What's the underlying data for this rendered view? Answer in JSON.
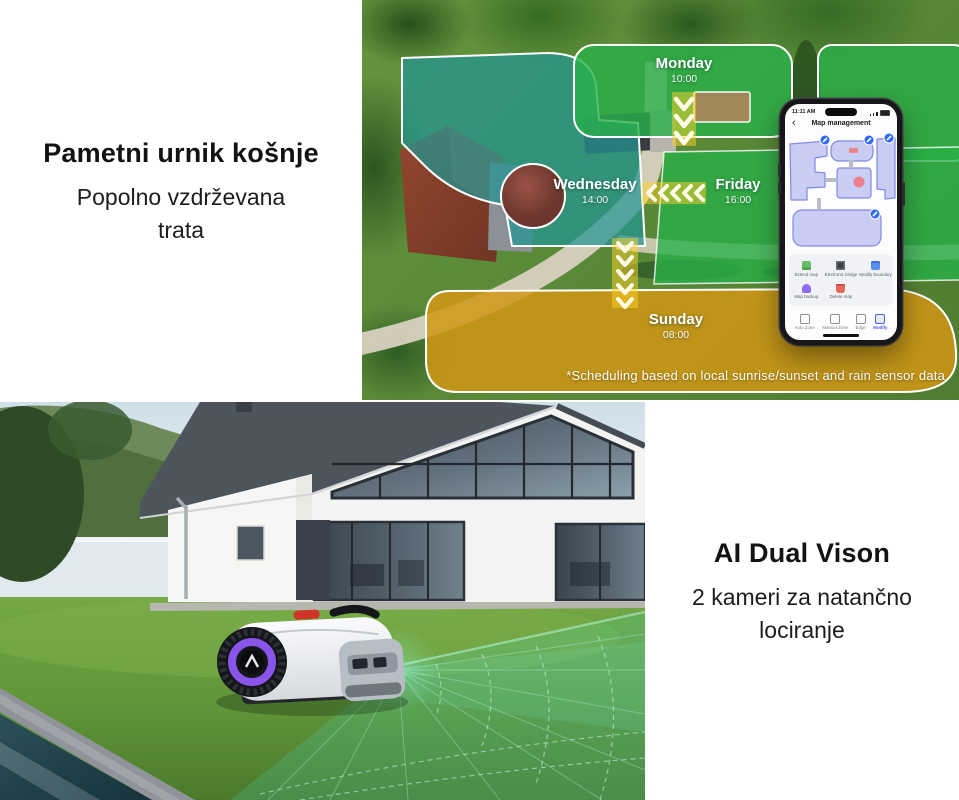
{
  "schedule_section": {
    "heading": "Pametni urnik košnje",
    "subheading": "Popolno vzdrževana trata",
    "disclaimer": "*Scheduling based on local sunrise/sunset and rain sensor data",
    "zones": [
      {
        "day": "Monday",
        "time": "10:00"
      },
      {
        "day": "Wednesday",
        "time": "14:00"
      },
      {
        "day": "Friday",
        "time": "16:00"
      },
      {
        "day": "Sunday",
        "time": "08:00"
      }
    ]
  },
  "phone": {
    "status_time": "11:11 AM",
    "back_icon": "‹",
    "title": "Map management",
    "actions": [
      {
        "label": "Extend map"
      },
      {
        "label": "Electronic bridge"
      },
      {
        "label": "Modify boundary"
      },
      {
        "label": "Map backup"
      },
      {
        "label": "Delete map"
      }
    ],
    "toolbar": [
      {
        "label": "Auto Zone"
      },
      {
        "label": "Manual Zone"
      },
      {
        "label": "Edge"
      },
      {
        "label": "Modify"
      }
    ]
  },
  "vision_section": {
    "heading": "AI Dual Vison",
    "subheading": "2 kameri za natančno lociranje"
  },
  "colors": {
    "zone_green": "#28b048",
    "zone_teal": "#22948f",
    "zone_orange": "#d1961a",
    "chevron_yellow": "#ffd228",
    "accent_blue": "#2e6cf5",
    "wheel_purple": "#8a55ea"
  }
}
